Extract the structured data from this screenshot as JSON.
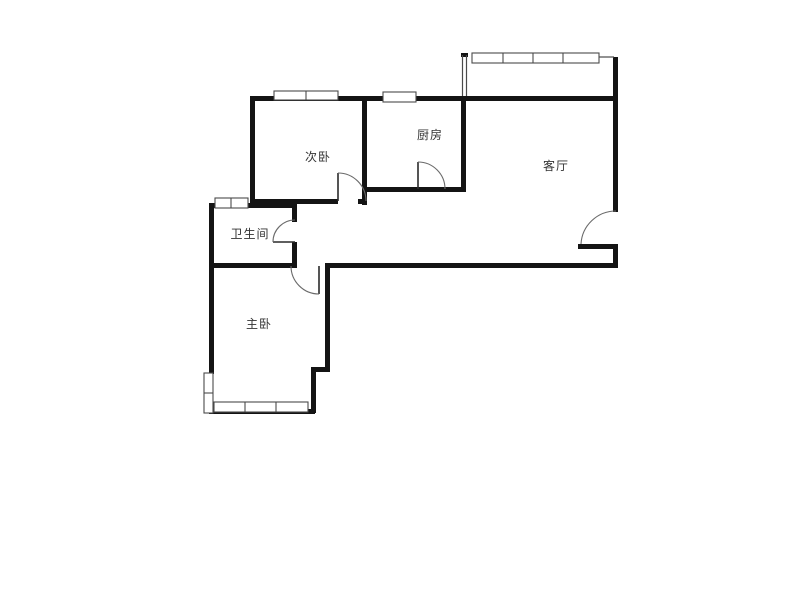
{
  "floor_plan": {
    "type": "apartment-floor-plan",
    "rooms": [
      {
        "id": "secondary-bedroom",
        "label": "次卧"
      },
      {
        "id": "kitchen",
        "label": "厨房"
      },
      {
        "id": "living-room",
        "label": "客厅"
      },
      {
        "id": "bathroom",
        "label": "卫生间"
      },
      {
        "id": "master-bedroom",
        "label": "主卧"
      }
    ],
    "features": {
      "windows": 6,
      "doors": 5,
      "balcony_window_dividers": 3
    },
    "colors": {
      "wall": "#141414",
      "line": "#4a4a4a",
      "label": "#333333",
      "background": "#ffffff"
    }
  }
}
